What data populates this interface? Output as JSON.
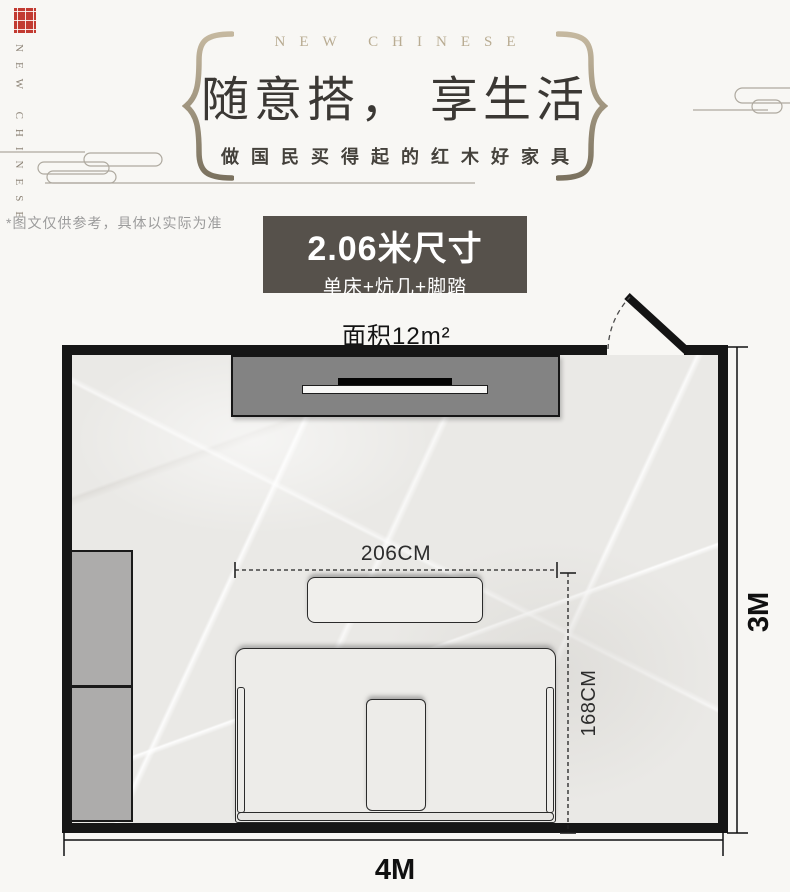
{
  "brand": {
    "vertical_text": "NEW CHINESE",
    "seal_color": "#c23a31"
  },
  "hero": {
    "eyebrow": "NEW CHINESE",
    "title": "随意搭， 享生活",
    "subtitle": "做国民买得起的红木好家具",
    "accent_color": "#a3967f"
  },
  "disclaimer": "*图文仅供参考，具体以实际为准",
  "spec_card": {
    "title": "2.06米尺寸",
    "subtitle": "单床+炕几+脚踏",
    "bg_color": "#56514b"
  },
  "floorplan": {
    "area_label": "面积12m²",
    "room_width_label": "4M",
    "room_height_label": "3M",
    "bed_width_label": "206CM",
    "bed_depth_label": "168CM",
    "furniture": [
      "tv-cabinet",
      "wardrobe",
      "kang-table",
      "single-bed",
      "footstool"
    ],
    "wall_color": "#161616",
    "floor_color": "#eae9e6"
  }
}
